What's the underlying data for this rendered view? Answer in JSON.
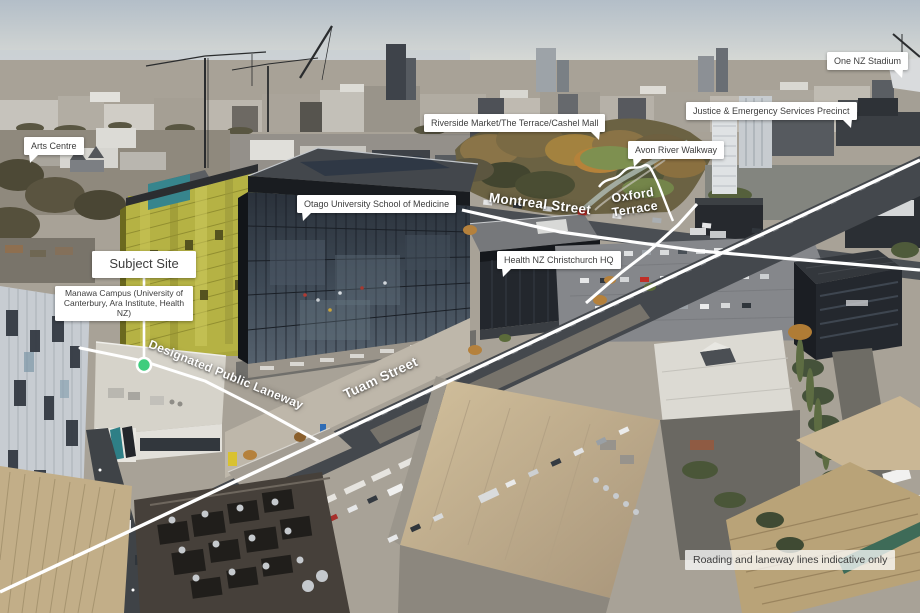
{
  "labels": {
    "arts_centre": "Arts Centre",
    "one_nz_stadium": "One NZ Stadium",
    "justice_precinct": "Justice & Emergency Services Precinct",
    "riverside_market": "Riverside Market/The Terrace/Cashel Mall",
    "avon_river_walkway": "Avon River Walkway",
    "otago_medicine": "Otago University School of Medicine",
    "health_nz_hq": "Health NZ Christchurch HQ",
    "subject_site": "Subject Site",
    "manawa_campus": "Manawa Campus (University of Canterbury, Ara Institute, Health NZ)"
  },
  "street_labels": {
    "montreal": "Montreal Street",
    "oxford": "Oxford Terrace",
    "tuam": "Tuam Street",
    "laneway": "Designated Public Laneway"
  },
  "disclaimer": "Roading and laneway lines indicative only",
  "marker": {
    "name": "subject-site-marker",
    "color": "#3ecd7d",
    "ring": "#ffffff"
  },
  "palette": {
    "sky_top": "#b3bec8",
    "sky_horizon": "#dcddd7",
    "distant_city": "#a8a297",
    "park_trees": "#6b6243",
    "autumn_tree": "#b5823a",
    "lawn": "#7c8d4a",
    "glass_building": "#3d4854",
    "scaffold_yellow": "#b5b244",
    "teal_patch": "#37858d",
    "road": "#45494e",
    "beige_roof": "#c6b38e",
    "label_bg": "#ffffff",
    "label_text": "#3d3d3d",
    "overlay_line": "#ffffff"
  }
}
